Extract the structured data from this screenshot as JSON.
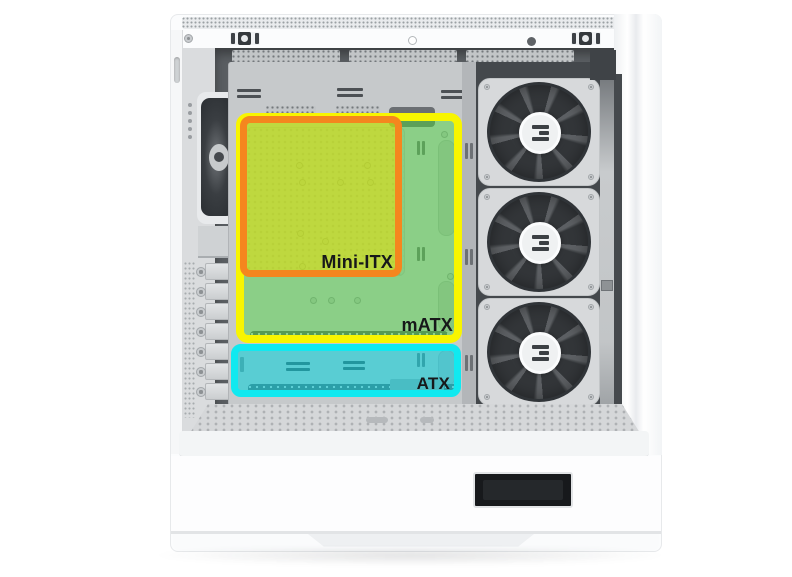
{
  "diagram": {
    "background_color": "#ffffff"
  },
  "zones": {
    "mini_itx": {
      "label": "Mini-ITX",
      "border_color": "#f5861e",
      "fill_color": "rgba(240,226,0,0.52)",
      "style": "border-color:#f5861e;background-color:rgba(240,226,0,0.52)"
    },
    "matx": {
      "label": "mATX",
      "border_color": "#f8f500",
      "fill_color": "rgba(76,214,60,0.48)",
      "style": "border-color:#f8f500;background-color:rgba(76,214,60,0.48)"
    },
    "atx": {
      "label": "ATX",
      "border_color": "#10e9f0",
      "fill_color": "rgba(0,208,218,0.55)",
      "style": "border-color:#10e9f0;background-color:rgba(0,208,218,0.55)"
    }
  },
  "case": {
    "fan_count": 3,
    "pci_slot_count": 7,
    "colors": {
      "body": "#fbfcfd",
      "interior": "#5a5e62",
      "tray": "#c6c9cb",
      "fan_blade": "#3e4246",
      "badge": "#17191c"
    }
  }
}
